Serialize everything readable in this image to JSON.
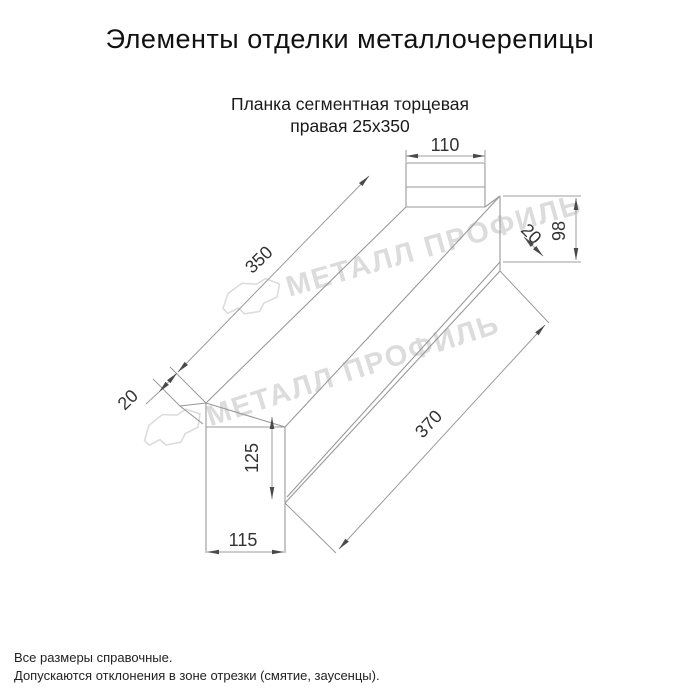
{
  "header": {
    "title": "Элементы отделки металлочерепицы"
  },
  "product": {
    "name_line1": "Планка сегментная торцевая",
    "name_line2": "правая 25х350"
  },
  "drawing": {
    "dims": {
      "top_flange_width": "110",
      "main_length": "350",
      "left_end_fold": "20",
      "right_end_height": "98",
      "right_end_fold": "20",
      "left_end_height": "125",
      "left_end_bottom_width": "115",
      "overall_length": "370"
    }
  },
  "watermark": {
    "text": "МЕТАЛЛ ПРОФИЛЬ",
    "color": "#dcdcdc"
  },
  "footer": {
    "note1": "Все размеры справочные.",
    "note2": "Допускаются отклонения в зоне отрезки (смятие, заусенцы)."
  },
  "colors": {
    "background": "#ffffff",
    "drawing_line": "#999999",
    "dim_text": "#333333",
    "title_text": "#111111",
    "watermark": "#dcdcdc"
  }
}
